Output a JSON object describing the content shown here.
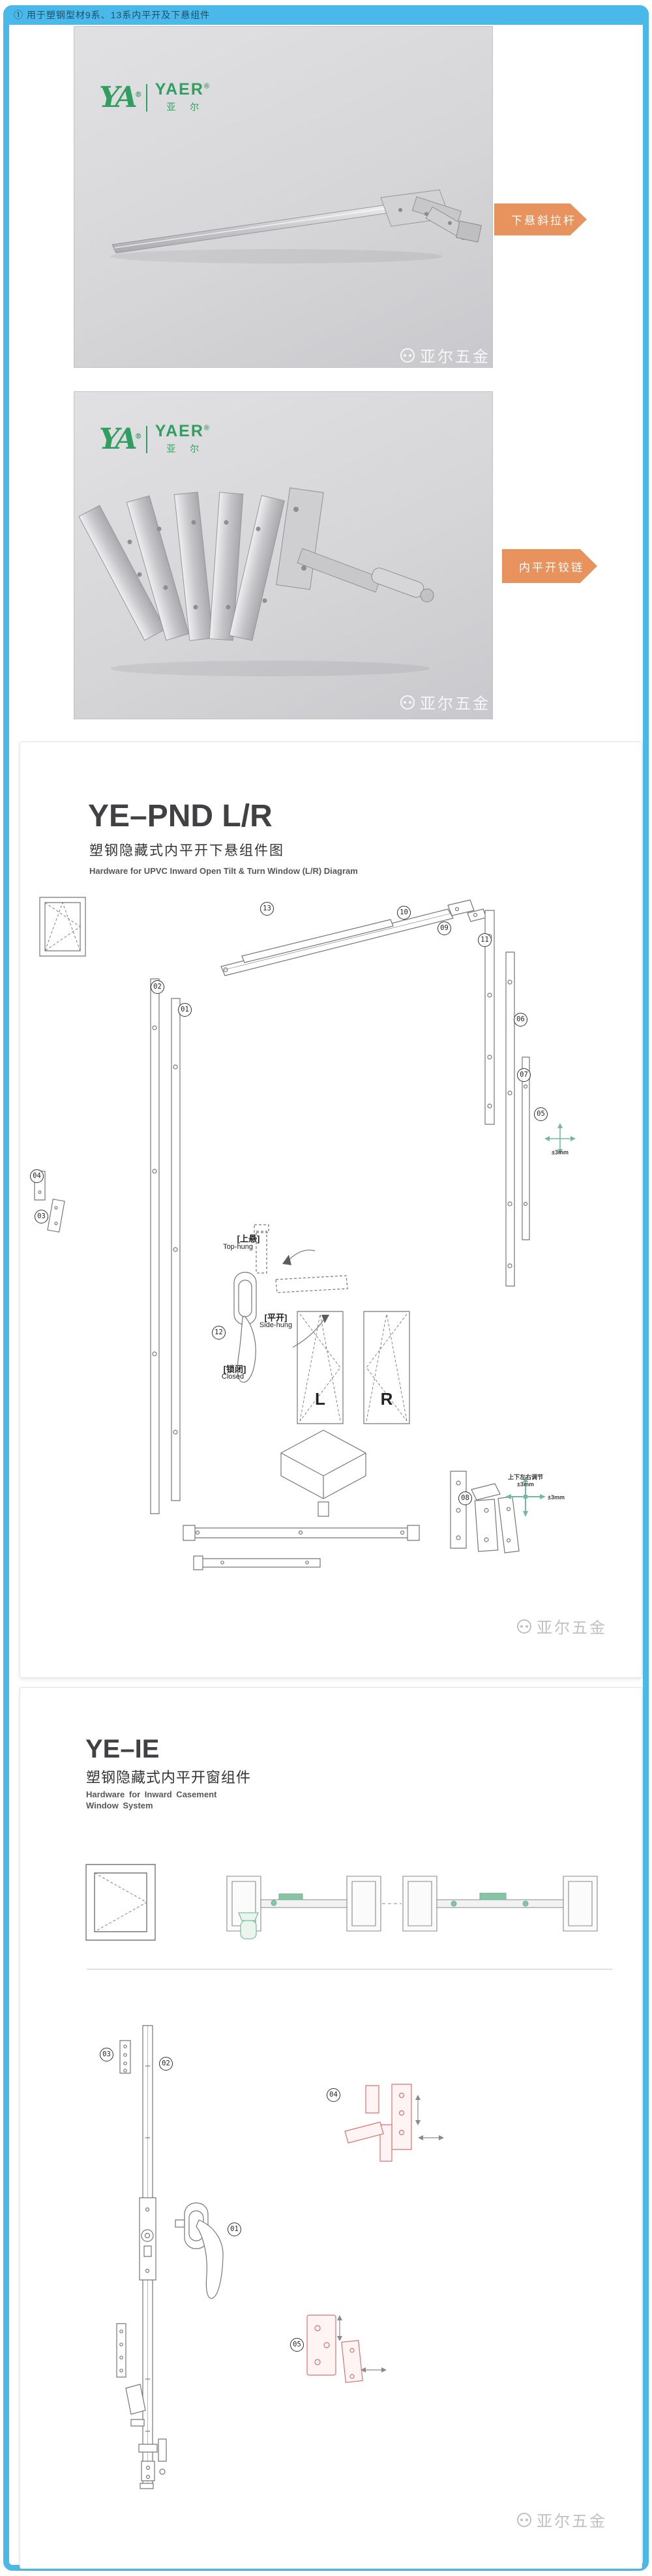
{
  "page": {
    "note": "① 用于塑钢型材9系、13系内平开及下悬组件"
  },
  "colors": {
    "accent": "#4ab9e9",
    "orange": "#e8935e",
    "brand_green": "#2f9e5f",
    "red_part": "#d9716e",
    "teal_arrow": "#74b8a3"
  },
  "brand": {
    "monogram": "YA",
    "reg": "®",
    "name": "YAER",
    "cn": "亚 尔"
  },
  "watermark": {
    "text": "亚尔五金"
  },
  "photos": [
    {
      "tag": "下悬斜拉杆"
    },
    {
      "tag": "内平开铰链"
    }
  ],
  "sections": [
    {
      "title": "YE–PND L/R",
      "subtitle_cn": "塑钢隐藏式内平开下悬组件图",
      "subtitle_en": "Hardware for UPVC  Inward Open Tilt & Turn Window (L/R) Diagram",
      "labels": {
        "top_hung_cn": "[上悬]",
        "top_hung_en": "Top-hung",
        "side_hung_cn": "[平开]",
        "side_hung_en": "Side-hung",
        "closed_cn": "[锁闭]",
        "closed_en": "Closed",
        "left": "L",
        "right": "R",
        "adjust_cn": "上下左右调节",
        "adjust_v": "±3mm",
        "adjust_h": "±3mm",
        "adjust_r": "±3mm"
      },
      "callouts": [
        "13",
        "10",
        "09",
        "11",
        "06",
        "07",
        "05",
        "04",
        "03",
        "02",
        "01",
        "12",
        "08"
      ]
    },
    {
      "title": "YE–IE",
      "subtitle_cn": "塑钢隐藏式内平开窗组件",
      "subtitle_en1": "Hardware for Inward Casement",
      "subtitle_en2": "Window System",
      "callouts": [
        "03",
        "02",
        "01",
        "04",
        "05"
      ]
    }
  ]
}
